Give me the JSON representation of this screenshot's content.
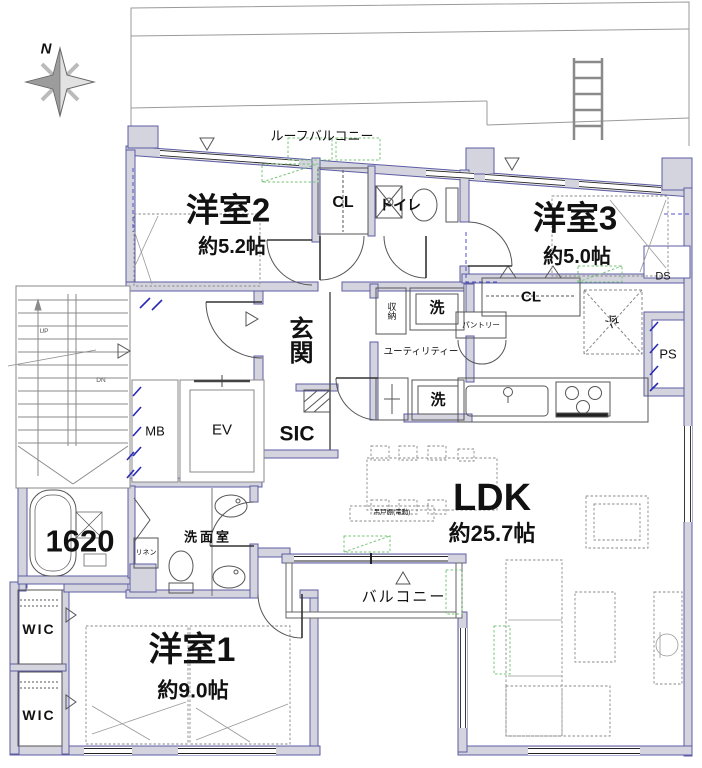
{
  "compass": {
    "north_label": "N"
  },
  "outdoor": {
    "roof_balcony": "ルーフバルコニー",
    "balcony": "バルコニー"
  },
  "rooms": {
    "western2": {
      "name": "洋室2",
      "size": "約5.2帖"
    },
    "western3": {
      "name": "洋室3",
      "size": "約5.0帖"
    },
    "western1": {
      "name": "洋室1",
      "size": "約9.0帖"
    },
    "ldk": {
      "name": "LDK",
      "size": "約25.7帖"
    },
    "entrance": {
      "name": "玄関"
    },
    "sic": {
      "name": "SIC"
    },
    "washroom": {
      "name": "洗面室"
    },
    "utility": {
      "name": "ユーティリティー"
    },
    "toilet": {
      "name": "トイレ"
    },
    "bath": {
      "size_label": "1620"
    }
  },
  "storage": {
    "closet_hall": "CL",
    "closet_west3": "CL",
    "wic_upper": "WIC",
    "wic_lower": "WIC",
    "linen": "リネン",
    "shuno": "収納",
    "pantry": "パントリー"
  },
  "fixtures": {
    "washer_upper": "洗",
    "washer_lower": "洗",
    "fridge": "冷",
    "meter_box": "MB",
    "elevator": "EV",
    "pipe_space": "PS",
    "duct_space": "DS",
    "hanging_shelf": "吊戸棚(電動)"
  },
  "stairs": {
    "up": "UP",
    "down": "DN"
  }
}
